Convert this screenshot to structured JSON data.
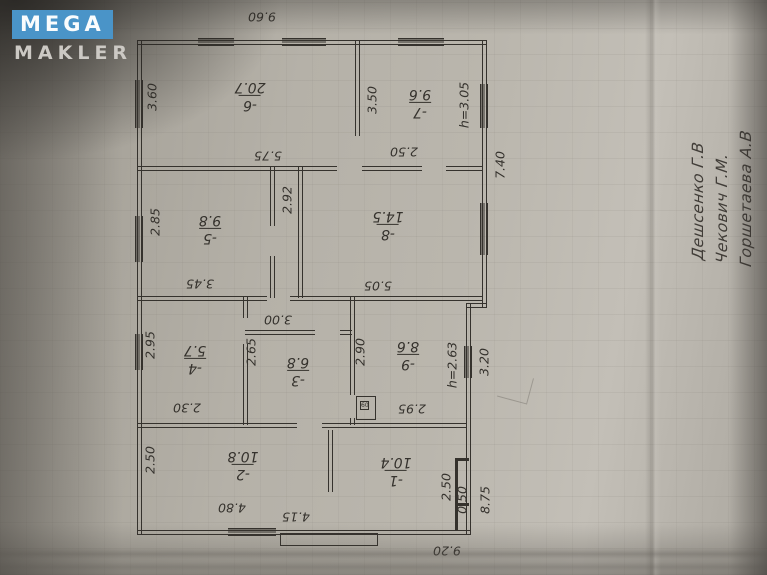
{
  "watermark": {
    "brand_top": "MEGA",
    "brand_bottom": "MAKLER"
  },
  "colors": {
    "ink": "#35322d",
    "logo_blue": "#4a94c8",
    "paper": "#b8b3aa"
  },
  "plan": {
    "rooms": [
      {
        "num": "-1",
        "area": "10.4"
      },
      {
        "num": "-2",
        "area": "10.8"
      },
      {
        "num": "-3",
        "area": "6.8"
      },
      {
        "num": "-4",
        "area": "5.7"
      },
      {
        "num": "-5",
        "area": "9.8"
      },
      {
        "num": "-6",
        "area": "20.7"
      },
      {
        "num": "-7",
        "area": "9.6"
      },
      {
        "num": "-8",
        "area": "14.5"
      },
      {
        "num": "-9",
        "area": "8.6"
      }
    ],
    "dims": {
      "top_width": "9.60",
      "bottom_width": "9.20",
      "right_upper": "7.40",
      "right_mid": "3.20",
      "right_lower": "8.75",
      "closet": "0.50",
      "h_front": "h=3.05",
      "h_back": "h=2.63",
      "r6_left": "3.60",
      "r6_bottom": "5.75",
      "r7_left": "3.50",
      "r7_bottom": "2.50",
      "r5_left": "2.85",
      "r5_bottom": "3.45",
      "r8_left": "2.92",
      "r8_bottom": "5.05",
      "r4_left": "2.95",
      "r4_bottom": "2.30",
      "r3_left": "2.65",
      "r3_top": "3.00",
      "r9_left": "2.90",
      "r9_bottom": "2.95",
      "r2_left": "2.50",
      "r2_bottom": "4.80",
      "r1_bottom": "4.15",
      "r1_right": "2.50"
    },
    "stove_mark": "60",
    "handwriting": [
      "Дешсенко Г.В",
      "Чекович Г.М.",
      "Горшетаева А.В"
    ]
  }
}
